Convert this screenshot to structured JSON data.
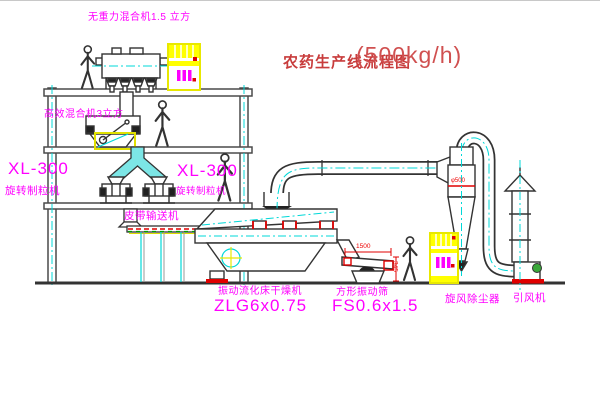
{
  "title": {
    "text": "农药生产线流程图",
    "capacity": "(500kg/h)"
  },
  "colors": {
    "label_magenta": "#ff00ff",
    "centerline_cyan": "#00d8d8",
    "cabinet_yellow": "#ffff00",
    "dimension_red": "#ee0000",
    "title_red": "#c83c3c",
    "line_gray": "#4a4a4a",
    "base_red": "#dd0000",
    "motor_green": "#3aa83a"
  },
  "labels": {
    "gravity_mixer": "无重力混合机1.5 立方",
    "high_eff_mixer": "高效混合机3立方",
    "granulator_left_model": "XL-300",
    "granulator_left_name": "旋转制粒机",
    "granulator_right_model": "XL-300",
    "granulator_right_name": "旋转制粒机",
    "belt_conveyor": "皮带输送机",
    "dryer_name": "振动流化床干燥机",
    "dryer_model": "ZLG6x0.75",
    "sieve_name": "方形振动筛",
    "sieve_model": "FS0.6x1.5",
    "cyclone": "旋风除尘器",
    "fan": "引风机"
  },
  "dimensions": {
    "sieve_length": "1500",
    "sieve_height": "345",
    "cyclone_diameter": "φ500"
  }
}
